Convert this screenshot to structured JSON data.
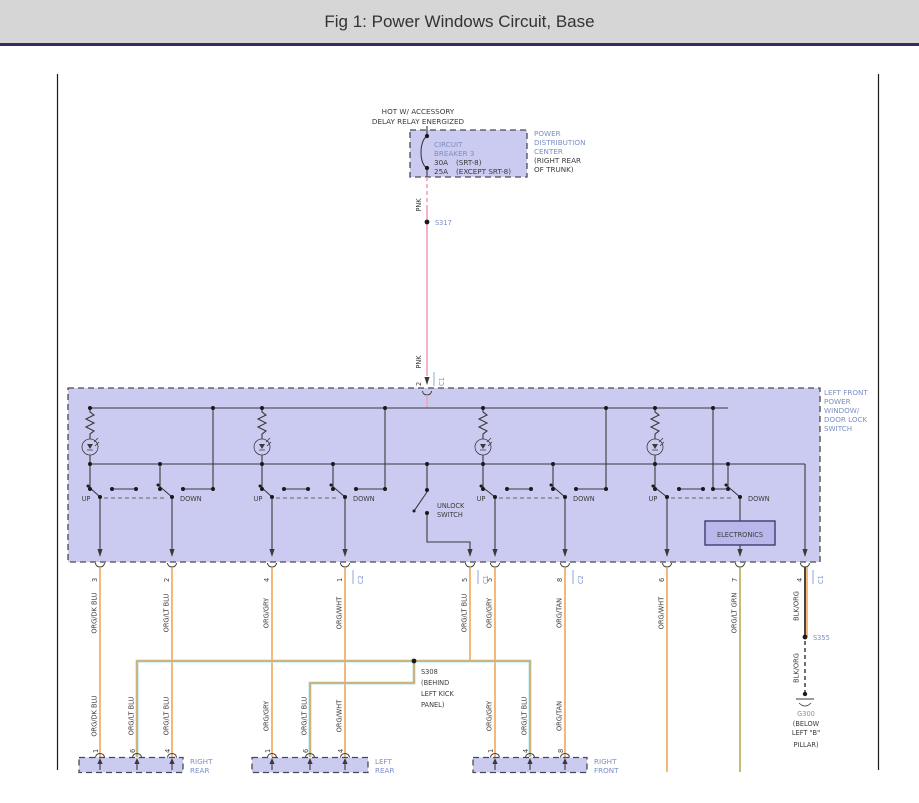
{
  "colors": {
    "accent_blue": "#7A8FC5",
    "wire_orange": "#ED9B40",
    "wire_pink": "#F2A2B8",
    "wire_olive": "#A8A03C",
    "wire_black": "#35322C",
    "wire_light_blue": "#9ADCE8",
    "block_fill": "#CBCBF1",
    "electronics_fill": "#B7B7EB",
    "header_bg": "#D6D6D6",
    "header_rule": "#30305E",
    "text_dark": "#3A3A3A"
  },
  "header": {
    "title": "Fig 1: Power Windows Circuit, Base"
  },
  "supply": {
    "hot1": "HOT W/ ACCESSORY",
    "hot2": "DELAY RELAY ENERGIZED",
    "breaker_l1": "CIRCUIT",
    "breaker_l2": "BREAKER 3",
    "amp1": "30A",
    "amp1_note": "(SRT-8)",
    "amp2": "25A",
    "amp2_note": "(EXCEPT SRT-8)",
    "pdc0": "POWER",
    "pdc1": "DISTRIBUTION",
    "pdc2": "CENTER",
    "pdc3": "(RIGHT REAR",
    "pdc4": "OF TRUNK)",
    "pnk": "PNK",
    "s317": "S317",
    "pin": "2",
    "conn": "C1"
  },
  "switch_block": {
    "l0": "LEFT FRONT",
    "l1": "POWER",
    "l2": "WINDOW/",
    "l3": "DOOR LOCK",
    "l4": "SWITCH",
    "up": "UP",
    "down": "DOWN",
    "unlock1": "UNLOCK",
    "unlock2": "SWITCH",
    "electronics": "ELECTRONICS"
  },
  "pins_top": [
    {
      "pin": "3",
      "color": "ORG/DK BLU"
    },
    {
      "pin": "2",
      "color": "ORG/LT BLU"
    },
    {
      "pin": "4",
      "color": "ORG/GRY"
    },
    {
      "pin": "1",
      "conn": "C2",
      "color": "ORG/WHT"
    },
    {
      "pin": "5",
      "conn": "C1",
      "color": "ORG/LT BLU"
    },
    {
      "pin": "5",
      "color": "ORG/GRY"
    },
    {
      "pin": "8",
      "conn": "C2",
      "color": "ORG/TAN"
    },
    {
      "pin": "6",
      "color": "ORG/WHT"
    },
    {
      "pin": "7",
      "color": "ORG/LT GRN"
    },
    {
      "pin": "4",
      "conn": "C1",
      "color": "BLK/ORG"
    }
  ],
  "splices": {
    "s308_0": "S308",
    "s308_1": "(BEHIND",
    "s308_2": "LEFT KICK",
    "s308_3": "PANEL)",
    "s355": "S355",
    "blk_org": "BLK/ORG"
  },
  "ground": {
    "g0": "G300",
    "g1": "(BELOW",
    "g2": "LEFT \"B\"",
    "g3": "PILLAR)"
  },
  "lower_labels": [
    "ORG/DK BLU",
    "ORG/LT BLU",
    "ORG/LT BLU",
    "ORG/GRY",
    "ORG/LT BLU",
    "ORG/WHT",
    "ORG/GRY",
    "ORG/LT BLU",
    "ORG/TAN"
  ],
  "bottom_blocks": [
    {
      "l1": "RIGHT",
      "l2": "REAR",
      "p0": "1",
      "p1": "6",
      "p2": "4"
    },
    {
      "l1": "LEFT",
      "l2": "REAR",
      "p0": "1",
      "p1": "6",
      "p2": "4"
    },
    {
      "l1": "RIGHT",
      "l2": "FRONT",
      "p0": "1",
      "p1": "4",
      "p2": "8"
    }
  ]
}
